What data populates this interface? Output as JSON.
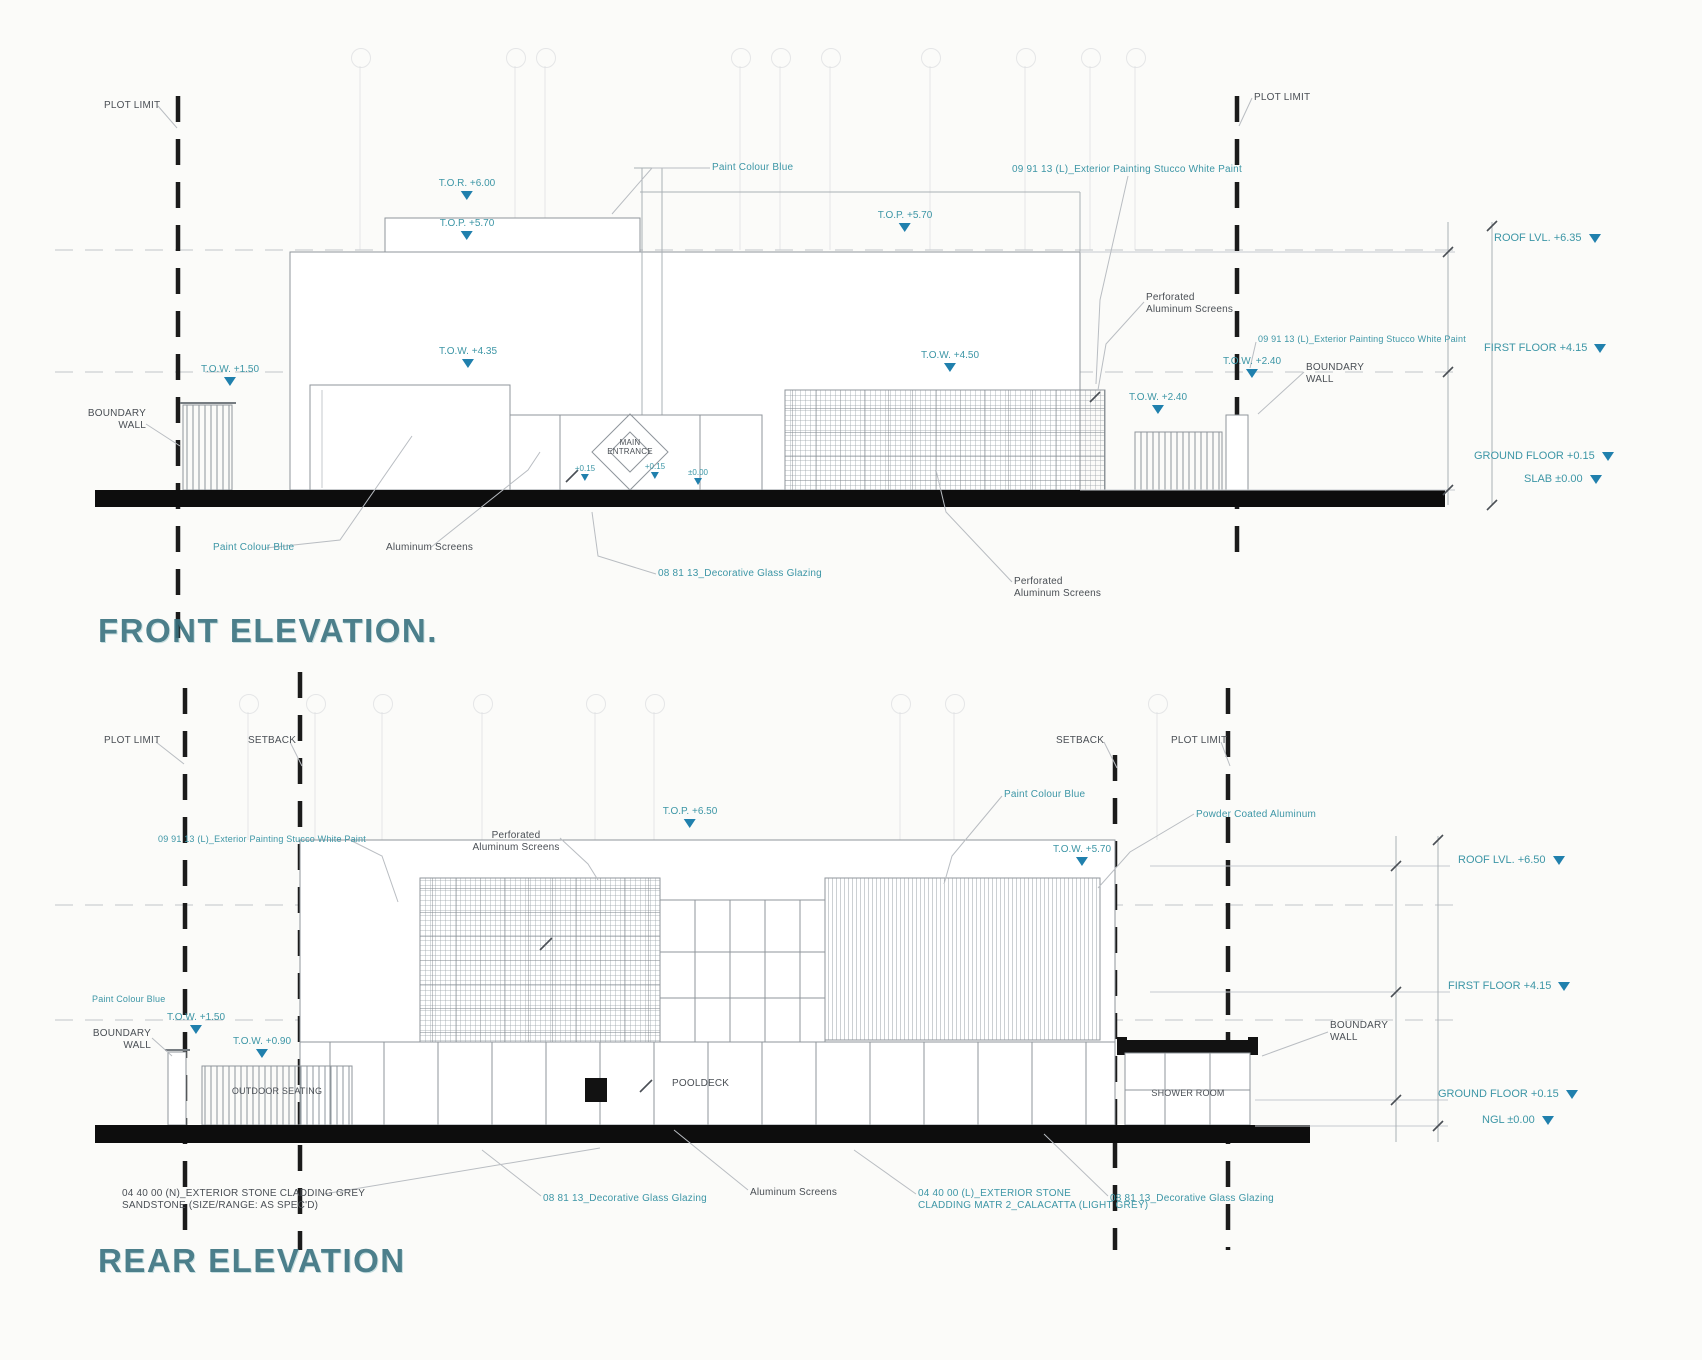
{
  "palette": {
    "annotation_teal": "#3D96A6",
    "ink": "#4A4F55",
    "marker_blue": "#2080AD",
    "line_gray": "#8F959B",
    "ground_black": "#0D0D0D",
    "title_teal": "#3A7280"
  },
  "common": {
    "plot_limit": "PLOT LIMIT",
    "setback": "SETBACK",
    "boundary_wall_1": "BOUNDARY",
    "boundary_wall_2": "WALL"
  },
  "materials": {
    "paint_blue": "Paint Colour Blue",
    "stucco_white": "09 91 13 (L)_Exterior Painting Stucco White Paint",
    "decorative_glass": "08 81 13_Decorative Glass Glazing",
    "aluminum_screens": "Aluminum Screens",
    "perforated_1": "Perforated",
    "perforated_2": "Aluminum Screens",
    "powder_coated": "Powder Coated Aluminum",
    "stone_grey_1": "04 40 00 (N)_EXTERIOR STONE CLADDING GREY",
    "stone_grey_2": "SANDSTONE (SIZE/RANGE: AS SPEC'D)",
    "stone_calacatta_1": "04 40 00 (L)_EXTERIOR STONE",
    "stone_calacatta_2": "CLADDING MATR 2_CALACATTA (LIGHT GREY)"
  },
  "front": {
    "title": "FRONT ELEVATION.",
    "entrance_1": "MAIN",
    "entrance_2": "ENTRANCE",
    "levels": {
      "tor": "T.O.R. +6.00",
      "top_mid": "T.O.P. +5.70",
      "top_right": "T.O.P. +5.70",
      "tow_wall": "T.O.W. +1.50",
      "tow_inner": "T.O.W. +4.35",
      "tow_screen": "T.O.W. +4.50",
      "tow_fence": "T.O.W. +2.40",
      "tow_bwall": "T.O.W. +2.40",
      "base_a": "+0.15",
      "base_b": "+0.15",
      "base_c": "±0.00"
    },
    "margin": {
      "roof": "ROOF LVL. +6.35",
      "first": "FIRST FLOOR +4.15",
      "ground": "GROUND FLOOR +0.15",
      "slab": "SLAB ±0.00"
    }
  },
  "rear": {
    "title": "REAR ELEVATION",
    "rooms": {
      "pooldeck": "POOLDECK",
      "outdoor_seating": "OUTDOOR SEATING",
      "shower_room": "SHOWER ROOM"
    },
    "levels": {
      "top_parapet": "T.O.P. +6.50",
      "tow_louver": "T.O.W. +5.70",
      "tow_wall": "T.O.W. +1.50",
      "tow_fence": "T.O.W. +0.90"
    },
    "margin": {
      "roof": "ROOF LVL. +6.50",
      "first": "FIRST FLOOR +4.15",
      "ground": "GROUND FLOOR +0.15",
      "ngl": "NGL ±0.00"
    }
  }
}
